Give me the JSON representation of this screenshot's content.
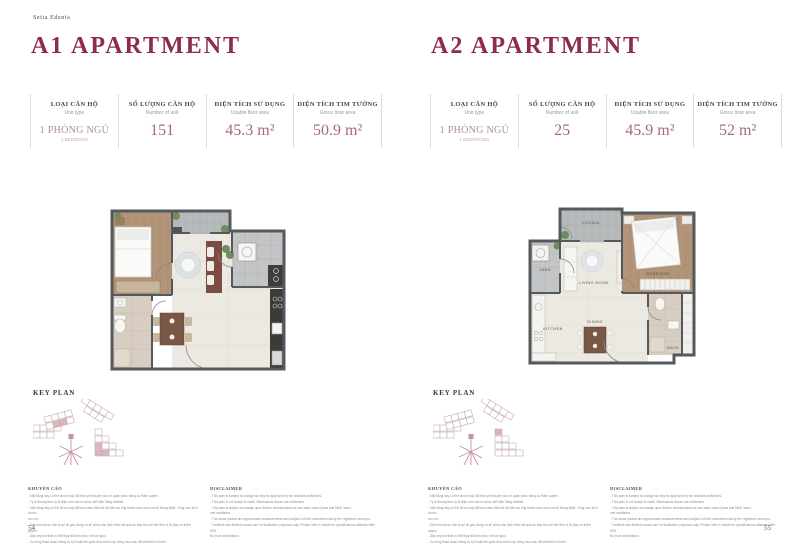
{
  "brand": "Setia Edenia",
  "spec_headers": [
    {
      "vi": "LOẠI CĂN HỘ",
      "en": "Unit type"
    },
    {
      "vi": "SỐ LƯỢNG CĂN HỘ",
      "en": "Number of unit"
    },
    {
      "vi": "DIỆN TÍCH SỬ DỤNG",
      "en": "Usable floor area"
    },
    {
      "vi": "DIỆN TÍCH TIM TƯỜNG",
      "en": "Gross floor area"
    }
  ],
  "pages": [
    {
      "title": "A1 APARTMENT",
      "key_plan_label": "KEY PLAN",
      "page_number": "54",
      "specs": {
        "unit_type": "1 PHÒNG NGỦ",
        "unit_type_sub": "1 BEDROOM",
        "unit_count": "151",
        "usable_area": "45.3 m²",
        "gross_area": "50.9 m²"
      }
    },
    {
      "title": "A2 APARTMENT",
      "key_plan_label": "KEY PLAN",
      "page_number": "55",
      "specs": {
        "unit_type": "1 PHÒNG NGỦ",
        "unit_type_sub": "1 BEDROOMS",
        "unit_count": "25",
        "usable_area": "45.9 m²",
        "gross_area": "52 m²"
      },
      "room_labels": {
        "loggia": "LOGGIA",
        "yard": "YARD",
        "living": "LIVING ROOM",
        "bedroom": "BEDROOM",
        "kitchen": "KITCHEN",
        "dining": "DINING",
        "bath": "BATH"
      }
    }
  ],
  "disclaimer_vi": {
    "title": "KHUYẾN CÁO",
    "lines": [
      "- Mặt bằng này có thể được thay đổi theo phê duyệt của cơ quan chức năng có thẩm quyền.",
      "- Tỷ lệ không theo tỷ lệ thật, kích thước được thể hiện bằng milimét.",
      "- Mặt bằng này có thể được thay đổi dựa theo thiết kế chi tiết các ống thoát nước mưa và hệ thống M&E, cũng như kích thước",
      "  và vị trí.",
      "- Diện tích được tính là số đo gần đúng và sẽ được xác định theo kết quả đo đạc thực tế bởi đơn vị đo đạc có thẩm quyền.",
      "- Sắp xếp nội thất có thể thay đổi theo thực tế bàn giao.",
      "- Vui lòng tham khảo thông số kỹ thuật bàn giao đính kèm hợp đồng mua bán để biết thêm chi tiết."
    ]
  },
  "disclaimer_en": {
    "title": "DISCLAIMER",
    "lines": [
      "- This plan is subject to change as may be approved by the relevant authorities.",
      "- This plan is not drawn to scale. Dimensions shown are milimeters.",
      "- This plan is subject to change upon further developments to rain water down pipes and M&E risers",
      "  and ancillaries.",
      "- The areas quoted are approximate measurements and subject to final measurements by the registered surveyor.",
      "- Furniture and finishes shown are for illustration purposes only. Please refer to handover specifications attached with SPA",
      "  for more information."
    ]
  },
  "colors": {
    "title_maroon": "#8e2c4e",
    "value_rose": "#a56a74",
    "wall_gray": "#54595d",
    "wood_floor": "#b29478",
    "living_floor": "#ece9e2",
    "tile_gray": "#b7babb",
    "bath_beige": "#d7cdc1",
    "keyplan_pink": "#dcb5bc"
  }
}
